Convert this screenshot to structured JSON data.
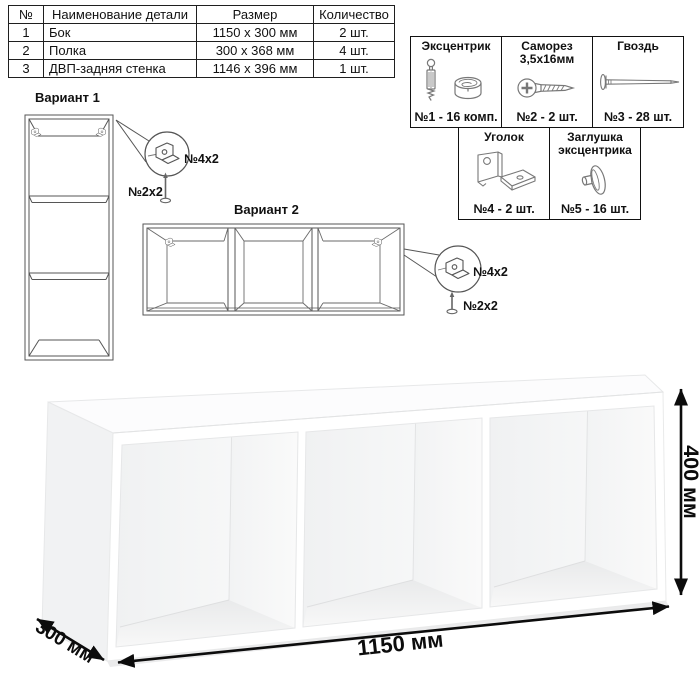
{
  "parts_table": {
    "headers": [
      "№",
      "Наименование детали",
      "Размер",
      "Количество"
    ],
    "rows": [
      {
        "num": "1",
        "name": "Бок",
        "size": "1150 x 300 мм",
        "qty": "2 шт."
      },
      {
        "num": "2",
        "name": "Полка",
        "size": "300 x 368 мм",
        "qty": "4 шт."
      },
      {
        "num": "3",
        "name": "ДВП-задняя стенка",
        "size": "1146 x 396 мм",
        "qty": "1 шт."
      }
    ]
  },
  "hardware": {
    "row1": [
      {
        "title": "Эксцентрик",
        "subtitle": "",
        "count": "№1 - 16 комп."
      },
      {
        "title": "Саморез",
        "subtitle": "3,5x16мм",
        "count": "№2 - 2 шт."
      },
      {
        "title": "Гвоздь",
        "subtitle": "",
        "count": "№3 - 28 шт."
      }
    ],
    "row2": [
      {
        "title": "Уголок",
        "subtitle": "",
        "count": "№4 - 2 шт."
      },
      {
        "title": "Заглушка",
        "subtitle": "эксцентрика",
        "count": "№5 - 16 шт."
      }
    ]
  },
  "variant1": {
    "title": "Вариант 1",
    "bracket_label": "№4x2",
    "screw_label": "№2x2"
  },
  "variant2": {
    "title": "Вариант 2",
    "bracket_label": "№4x2",
    "screw_label": "№2x2"
  },
  "dimensions": {
    "width": "1150 мм",
    "depth": "300 мм",
    "height": "400 мм"
  }
}
